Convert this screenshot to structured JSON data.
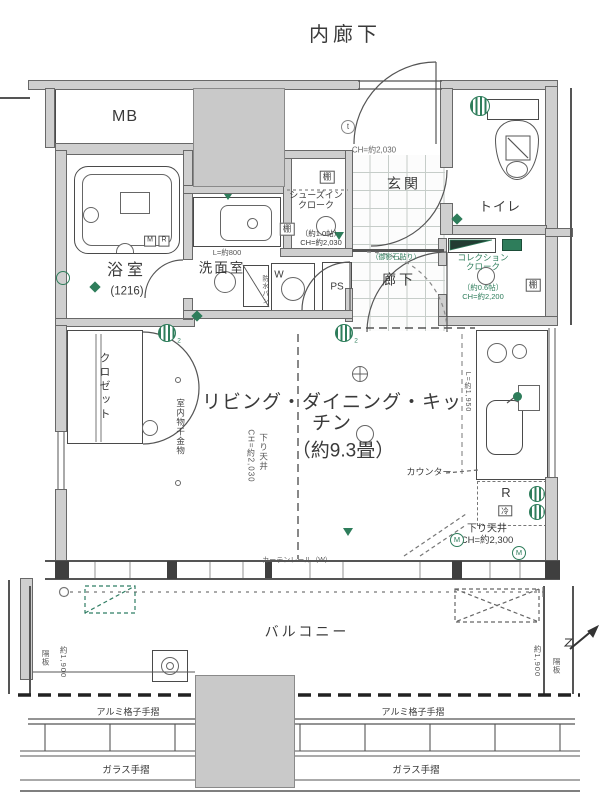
{
  "palette": {
    "accent_green": "#2e7d5b",
    "wall_gray": "#cfcfcf",
    "block_gray": "#c9c9c9",
    "line": "#4a4a4a"
  },
  "icons": {
    "vent_fan": "green-striped-circle",
    "meter": "green-circled-M",
    "door_closer": "small-circled-t",
    "north_arrow": "diagonal-arrow",
    "fixture_marker": "green-diamond",
    "downlight": "small-circle"
  },
  "labels": {
    "inner_corridor": "内廊下",
    "mb": "MB",
    "entrance_ch": "CH=約2,030",
    "entrance": "玄関",
    "entrance_note": "（御影石貼り）",
    "toilet": "トイレ",
    "shelf_sic": "棚",
    "sic_name": "シューズイン\nクローク",
    "sic_size": "（約1.0帖）",
    "sic_ch": "CH=約2,030",
    "shelf_mid": "棚",
    "basin_len": "L=約800",
    "washroom": "洗面室",
    "bath": "浴室",
    "bath_size": "(1216)",
    "tag_m": "M",
    "tag_r": "R",
    "w_tag": "W",
    "w_sub": "防水パン",
    "ps": "PS",
    "hallway": "廊下",
    "sc_name": "コレクション\nクローク",
    "sc_size": "（約0.6帖）",
    "sc_ch": "CH=約2,200",
    "shelf_sc": "棚",
    "ldk": "リビング・ダイニング・キッチン",
    "ldk_size": "（約9.3畳）",
    "soffit1": "下り天井",
    "soffit1_ch": "CH=約2,030",
    "laundry": "室内物干金物",
    "closet": "クロゼット",
    "counter": "カウンター",
    "kitchen_len": "L=約1,950",
    "fridge_r": "R",
    "fridge_cold": "冷",
    "soffit2": "下り天井",
    "soffit2_ch": "CH=約2,300",
    "m1": "M",
    "m2": "M",
    "rail_note": "カーテンレール（W）",
    "balcony": "バルコニー",
    "partition_l": "隔板",
    "depth_l": "約1,900",
    "depth_r": "約1,900",
    "partition_r": "隔板",
    "alum_l": "アルミ格子手摺",
    "alum_r": "アルミ格子手摺",
    "glass_l": "ガラス手摺",
    "glass_r": "ガラス手摺",
    "closer_t": "t",
    "vent1_sub": "2",
    "vent2_sub": "2"
  }
}
